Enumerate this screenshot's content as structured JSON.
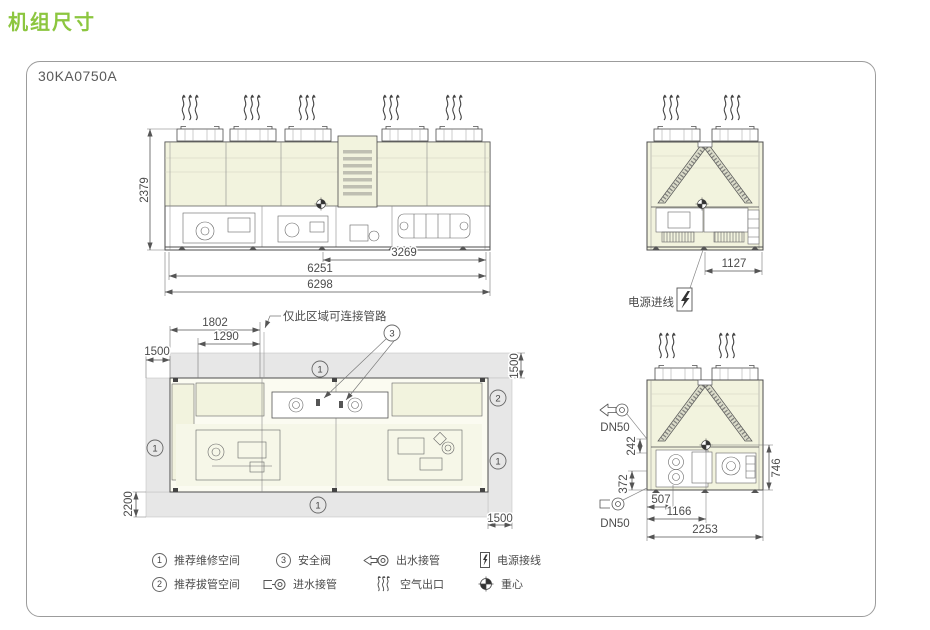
{
  "page": {
    "title": "机组尺寸",
    "model": "30KA0750A"
  },
  "colors": {
    "accent_green": "#8CC63F",
    "coil_fill": "#F2F3DE",
    "service_space_gray": "#E7E7E7",
    "line": "#4D4D4D",
    "dim_text": "#4C4C4C"
  },
  "front_view": {
    "dim_height": "2379",
    "dim_partial_width": "3269",
    "dim_inner_width": "6251",
    "dim_overall_width": "6298"
  },
  "end_view_top": {
    "dim_width": "1127",
    "power_inlet_label": "电源进线"
  },
  "plan_view": {
    "callout": "仅此区域可连接管路",
    "dim_a": "1802",
    "dim_b": "1290",
    "clearance_left": "1500",
    "clearance_top": "1500",
    "clearance_bottom": "2200",
    "clearance_right": "1500",
    "marker_service": "1",
    "marker_tube": "2",
    "marker_valve": "3"
  },
  "end_view_bottom": {
    "outlet_size": "DN50",
    "inlet_size": "DN50",
    "dim_outlet": "242",
    "dim_inlet": "372",
    "dim_cg_height": "746",
    "dim_a": "507",
    "dim_b": "1166",
    "dim_width": "2253"
  },
  "legend": {
    "service": {
      "marker": "1",
      "label": "推荐维修空间"
    },
    "tube": {
      "marker": "2",
      "label": "推荐拔管空间"
    },
    "valve": {
      "marker": "3",
      "label": "安全阀"
    },
    "inlet": {
      "label": "进水接管"
    },
    "outlet": {
      "label": "出水接管"
    },
    "air": {
      "label": "空气出口"
    },
    "power": {
      "label": "电源接线"
    },
    "gravity": {
      "label": "重心"
    }
  }
}
